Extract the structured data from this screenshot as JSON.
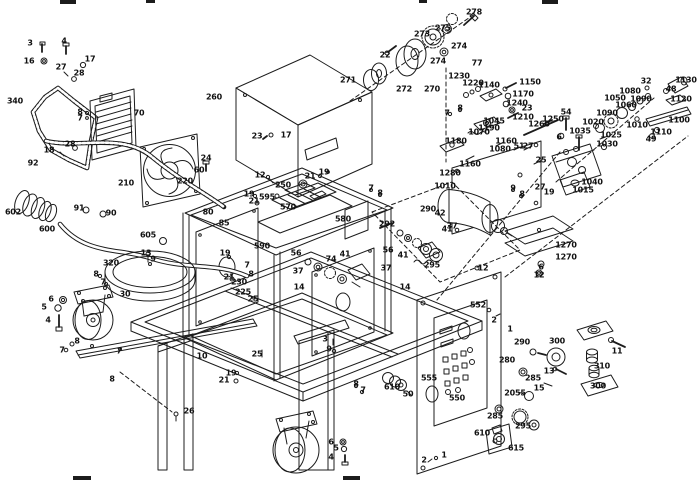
{
  "diagram": {
    "type": "exploded-parts-diagram",
    "description": "Exploded view spare-parts line drawing of a wheeled welding power source: gasket, radiator, fan, hoses, chassis frame, transformer, pulley and gear trains, drive motor, feeder assembly, control panel, casters and fasteners, with numbered part callouts",
    "background_color": "#ffffff",
    "line_color": "#1c1c1c",
    "label_color": "#111111"
  },
  "callouts": [
    {
      "t": "3",
      "x": 30,
      "y": 43
    },
    {
      "t": "16",
      "x": 29,
      "y": 61
    },
    {
      "t": "4",
      "x": 64,
      "y": 41
    },
    {
      "t": "17",
      "x": 90,
      "y": 59
    },
    {
      "t": "27",
      "x": 61,
      "y": 67
    },
    {
      "t": "28",
      "x": 79,
      "y": 73
    },
    {
      "t": "340",
      "x": 15,
      "y": 101
    },
    {
      "t": "8",
      "x": 80,
      "y": 112
    },
    {
      "t": "7",
      "x": 80,
      "y": 118
    },
    {
      "t": "70",
      "x": 139,
      "y": 113
    },
    {
      "t": "28",
      "x": 70,
      "y": 144
    },
    {
      "t": "18",
      "x": 49,
      "y": 150
    },
    {
      "t": "92",
      "x": 33,
      "y": 163
    },
    {
      "t": "602",
      "x": 13,
      "y": 212
    },
    {
      "t": "600",
      "x": 47,
      "y": 229
    },
    {
      "t": "91",
      "x": 79,
      "y": 208
    },
    {
      "t": "90",
      "x": 111,
      "y": 213
    },
    {
      "t": "210",
      "x": 126,
      "y": 183
    },
    {
      "t": "220",
      "x": 185,
      "y": 181
    },
    {
      "t": "24",
      "x": 206,
      "y": 158
    },
    {
      "t": "60",
      "x": 199,
      "y": 170
    },
    {
      "t": "260",
      "x": 214,
      "y": 97
    },
    {
      "t": "23",
      "x": 257,
      "y": 136
    },
    {
      "t": "17",
      "x": 286,
      "y": 135
    },
    {
      "t": "271",
      "x": 348,
      "y": 80
    },
    {
      "t": "272",
      "x": 404,
      "y": 89
    },
    {
      "t": "270",
      "x": 432,
      "y": 89
    },
    {
      "t": "22",
      "x": 385,
      "y": 55
    },
    {
      "t": "273",
      "x": 422,
      "y": 34
    },
    {
      "t": "275",
      "x": 443,
      "y": 28
    },
    {
      "t": "274",
      "x": 459,
      "y": 46
    },
    {
      "t": "274",
      "x": 438,
      "y": 61
    },
    {
      "t": "278",
      "x": 474,
      "y": 12
    },
    {
      "t": "77",
      "x": 477,
      "y": 63
    },
    {
      "t": "1230",
      "x": 459,
      "y": 76
    },
    {
      "t": "1220",
      "x": 473,
      "y": 83
    },
    {
      "t": "1140",
      "x": 489,
      "y": 85
    },
    {
      "t": "1150",
      "x": 530,
      "y": 82
    },
    {
      "t": "1170",
      "x": 523,
      "y": 94
    },
    {
      "t": "1240",
      "x": 517,
      "y": 103
    },
    {
      "t": "23",
      "x": 527,
      "y": 108
    },
    {
      "t": "1210",
      "x": 523,
      "y": 117
    },
    {
      "t": "8",
      "x": 460,
      "y": 108
    },
    {
      "t": "7",
      "x": 447,
      "y": 113
    },
    {
      "t": "1045",
      "x": 494,
      "y": 121
    },
    {
      "t": "1190",
      "x": 489,
      "y": 128
    },
    {
      "t": "1070",
      "x": 479,
      "y": 132
    },
    {
      "t": "1250",
      "x": 553,
      "y": 119
    },
    {
      "t": "1260",
      "x": 539,
      "y": 124
    },
    {
      "t": "54",
      "x": 566,
      "y": 112
    },
    {
      "t": "6",
      "x": 559,
      "y": 137
    },
    {
      "t": "1180",
      "x": 456,
      "y": 141
    },
    {
      "t": "1160",
      "x": 506,
      "y": 141
    },
    {
      "t": "51",
      "x": 519,
      "y": 146
    },
    {
      "t": "27",
      "x": 528,
      "y": 146
    },
    {
      "t": "1080",
      "x": 500,
      "y": 149
    },
    {
      "t": "25",
      "x": 541,
      "y": 160
    },
    {
      "t": "1160",
      "x": 470,
      "y": 164
    },
    {
      "t": "1280",
      "x": 450,
      "y": 173
    },
    {
      "t": "1010",
      "x": 445,
      "y": 186
    },
    {
      "t": "32",
      "x": 646,
      "y": 81
    },
    {
      "t": "1130",
      "x": 686,
      "y": 80
    },
    {
      "t": "48",
      "x": 671,
      "y": 89
    },
    {
      "t": "1120",
      "x": 681,
      "y": 99
    },
    {
      "t": "1080",
      "x": 630,
      "y": 91
    },
    {
      "t": "1050",
      "x": 615,
      "y": 98
    },
    {
      "t": "1090",
      "x": 641,
      "y": 99
    },
    {
      "t": "1060",
      "x": 626,
      "y": 105
    },
    {
      "t": "1090",
      "x": 607,
      "y": 113
    },
    {
      "t": "1010",
      "x": 637,
      "y": 125
    },
    {
      "t": "1100",
      "x": 679,
      "y": 120
    },
    {
      "t": "1110",
      "x": 661,
      "y": 132
    },
    {
      "t": "49",
      "x": 651,
      "y": 139
    },
    {
      "t": "1020",
      "x": 593,
      "y": 122
    },
    {
      "t": "1035",
      "x": 580,
      "y": 131
    },
    {
      "t": "1025",
      "x": 611,
      "y": 135
    },
    {
      "t": "1030",
      "x": 607,
      "y": 144
    },
    {
      "t": "27",
      "x": 540,
      "y": 187
    },
    {
      "t": "19",
      "x": 549,
      "y": 192
    },
    {
      "t": "1040",
      "x": 592,
      "y": 182
    },
    {
      "t": "1015",
      "x": 583,
      "y": 190
    },
    {
      "t": "1270",
      "x": 566,
      "y": 245
    },
    {
      "t": "1270",
      "x": 566,
      "y": 257
    },
    {
      "t": "6",
      "x": 541,
      "y": 267
    },
    {
      "t": "12",
      "x": 539,
      "y": 275
    },
    {
      "t": "12",
      "x": 260,
      "y": 175
    },
    {
      "t": "19",
      "x": 249,
      "y": 194
    },
    {
      "t": "21",
      "x": 254,
      "y": 201
    },
    {
      "t": "19",
      "x": 324,
      "y": 172
    },
    {
      "t": "21",
      "x": 310,
      "y": 176
    },
    {
      "t": "595",
      "x": 267,
      "y": 197
    },
    {
      "t": "250",
      "x": 283,
      "y": 185
    },
    {
      "t": "570",
      "x": 288,
      "y": 207
    },
    {
      "t": "580",
      "x": 343,
      "y": 219
    },
    {
      "t": "590",
      "x": 262,
      "y": 246
    },
    {
      "t": "7",
      "x": 371,
      "y": 188
    },
    {
      "t": "8",
      "x": 380,
      "y": 193
    },
    {
      "t": "9",
      "x": 513,
      "y": 188
    },
    {
      "t": "8",
      "x": 522,
      "y": 194
    },
    {
      "t": "80",
      "x": 208,
      "y": 212
    },
    {
      "t": "85",
      "x": 224,
      "y": 223
    },
    {
      "t": "19",
      "x": 225,
      "y": 253
    },
    {
      "t": "21",
      "x": 229,
      "y": 277
    },
    {
      "t": "605",
      "x": 148,
      "y": 235
    },
    {
      "t": "13",
      "x": 146,
      "y": 253
    },
    {
      "t": "9",
      "x": 153,
      "y": 259
    },
    {
      "t": "320",
      "x": 111,
      "y": 263
    },
    {
      "t": "230",
      "x": 239,
      "y": 282
    },
    {
      "t": "225",
      "x": 243,
      "y": 292
    },
    {
      "t": "25",
      "x": 253,
      "y": 299
    },
    {
      "t": "7",
      "x": 247,
      "y": 265
    },
    {
      "t": "8",
      "x": 251,
      "y": 274
    },
    {
      "t": "8",
      "x": 96,
      "y": 274
    },
    {
      "t": "7",
      "x": 103,
      "y": 282
    },
    {
      "t": "292",
      "x": 387,
      "y": 224
    },
    {
      "t": "290",
      "x": 428,
      "y": 209
    },
    {
      "t": "42",
      "x": 440,
      "y": 213
    },
    {
      "t": "37",
      "x": 452,
      "y": 226
    },
    {
      "t": "41",
      "x": 447,
      "y": 229
    },
    {
      "t": "56",
      "x": 388,
      "y": 250
    },
    {
      "t": "41",
      "x": 403,
      "y": 255
    },
    {
      "t": "37",
      "x": 386,
      "y": 268
    },
    {
      "t": "295",
      "x": 432,
      "y": 265
    },
    {
      "t": "14",
      "x": 405,
      "y": 287
    },
    {
      "t": "56",
      "x": 296,
      "y": 253
    },
    {
      "t": "41",
      "x": 345,
      "y": 254
    },
    {
      "t": "37",
      "x": 298,
      "y": 271
    },
    {
      "t": "14",
      "x": 299,
      "y": 287
    },
    {
      "t": "74",
      "x": 331,
      "y": 259
    },
    {
      "t": "12",
      "x": 483,
      "y": 268
    },
    {
      "t": "30",
      "x": 125,
      "y": 294
    },
    {
      "t": "6",
      "x": 51,
      "y": 299
    },
    {
      "t": "5",
      "x": 44,
      "y": 307
    },
    {
      "t": "4",
      "x": 48,
      "y": 320
    },
    {
      "t": "8",
      "x": 77,
      "y": 341
    },
    {
      "t": "7",
      "x": 62,
      "y": 350
    },
    {
      "t": "7",
      "x": 119,
      "y": 351
    },
    {
      "t": "8",
      "x": 112,
      "y": 379
    },
    {
      "t": "26",
      "x": 189,
      "y": 411
    },
    {
      "t": "10",
      "x": 202,
      "y": 356
    },
    {
      "t": "25",
      "x": 257,
      "y": 354
    },
    {
      "t": "19",
      "x": 231,
      "y": 373
    },
    {
      "t": "21",
      "x": 224,
      "y": 380
    },
    {
      "t": "3",
      "x": 325,
      "y": 339
    },
    {
      "t": "9",
      "x": 329,
      "y": 349
    },
    {
      "t": "8",
      "x": 356,
      "y": 384
    },
    {
      "t": "7",
      "x": 363,
      "y": 390
    },
    {
      "t": "6",
      "x": 331,
      "y": 442
    },
    {
      "t": "5",
      "x": 336,
      "y": 448
    },
    {
      "t": "4",
      "x": 331,
      "y": 457
    },
    {
      "t": "610",
      "x": 392,
      "y": 387
    },
    {
      "t": "50",
      "x": 408,
      "y": 394
    },
    {
      "t": "555",
      "x": 429,
      "y": 378
    },
    {
      "t": "550",
      "x": 457,
      "y": 398
    },
    {
      "t": "552",
      "x": 478,
      "y": 305
    },
    {
      "t": "2",
      "x": 494,
      "y": 320
    },
    {
      "t": "1",
      "x": 510,
      "y": 329
    },
    {
      "t": "290",
      "x": 522,
      "y": 342
    },
    {
      "t": "280",
      "x": 507,
      "y": 360
    },
    {
      "t": "285",
      "x": 533,
      "y": 378
    },
    {
      "t": "13",
      "x": 549,
      "y": 371
    },
    {
      "t": "15",
      "x": 539,
      "y": 388
    },
    {
      "t": "2055",
      "x": 515,
      "y": 393
    },
    {
      "t": "285",
      "x": 495,
      "y": 416
    },
    {
      "t": "295",
      "x": 523,
      "y": 426
    },
    {
      "t": "610",
      "x": 482,
      "y": 433
    },
    {
      "t": "615",
      "x": 516,
      "y": 448
    },
    {
      "t": "1",
      "x": 444,
      "y": 455
    },
    {
      "t": "2",
      "x": 424,
      "y": 460
    },
    {
      "t": "300",
      "x": 557,
      "y": 341
    },
    {
      "t": "11",
      "x": 617,
      "y": 351
    },
    {
      "t": "310",
      "x": 602,
      "y": 366
    },
    {
      "t": "300",
      "x": 598,
      "y": 386
    }
  ]
}
